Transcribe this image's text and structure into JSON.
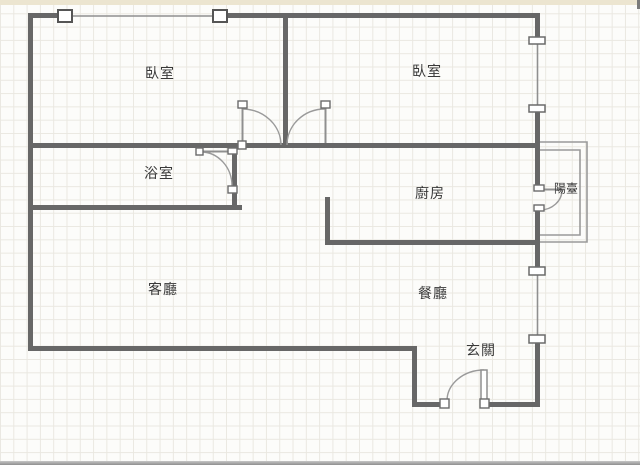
{
  "floorplan": {
    "rooms": [
      {
        "id": "bedroom-left",
        "label": "臥室"
      },
      {
        "id": "bedroom-right",
        "label": "臥室"
      },
      {
        "id": "bathroom",
        "label": "浴室"
      },
      {
        "id": "kitchen",
        "label": "廚房"
      },
      {
        "id": "living-room",
        "label": "客廳"
      },
      {
        "id": "dining-room",
        "label": "餐廳"
      },
      {
        "id": "entry",
        "label": "玄關"
      },
      {
        "id": "balcony",
        "label": "陽臺"
      }
    ],
    "colors": {
      "wall": "#676767",
      "window_line": "#8f8f8f",
      "door_arc": "#9a9a9a",
      "grid_line": "#eae8e1",
      "background": "#fcfcfa",
      "top_strip": "#ece5d0",
      "text": "#383838"
    }
  }
}
